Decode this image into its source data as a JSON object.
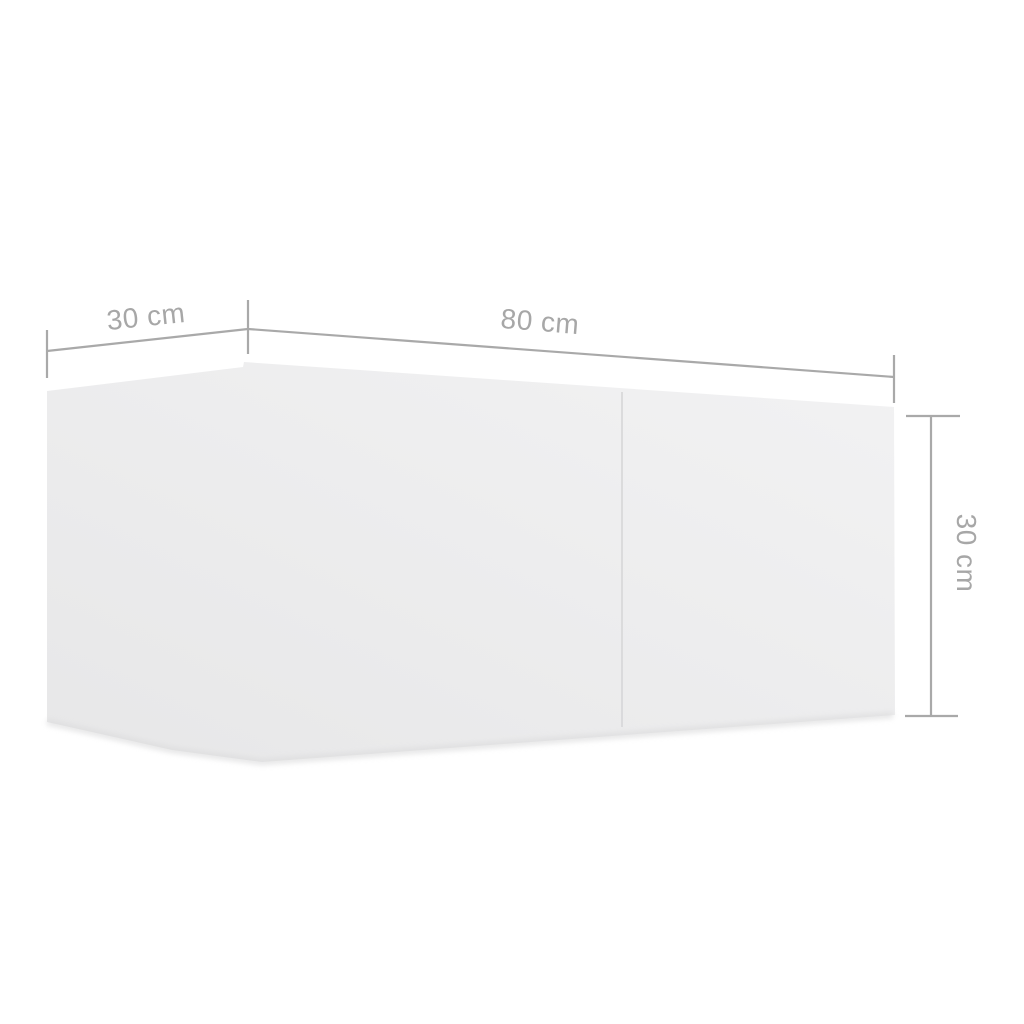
{
  "diagram": {
    "type": "product-dimension-diagram",
    "subject": "white wall-mounted TV cabinet, 3D perspective view with two front panels",
    "labels": {
      "depth": "30 cm",
      "width": "80 cm",
      "height": "30 cm"
    }
  },
  "colors": {
    "background": "#ffffff",
    "dimension_line": "#a9a9a9",
    "label_text": "#a7a7a7",
    "cabinet_face_light": "#f2f2f3",
    "cabinet_face_dark": "#e8e8e9",
    "door_seam": "#d9d9da",
    "bottom_shadow": "#dcdcdd"
  }
}
